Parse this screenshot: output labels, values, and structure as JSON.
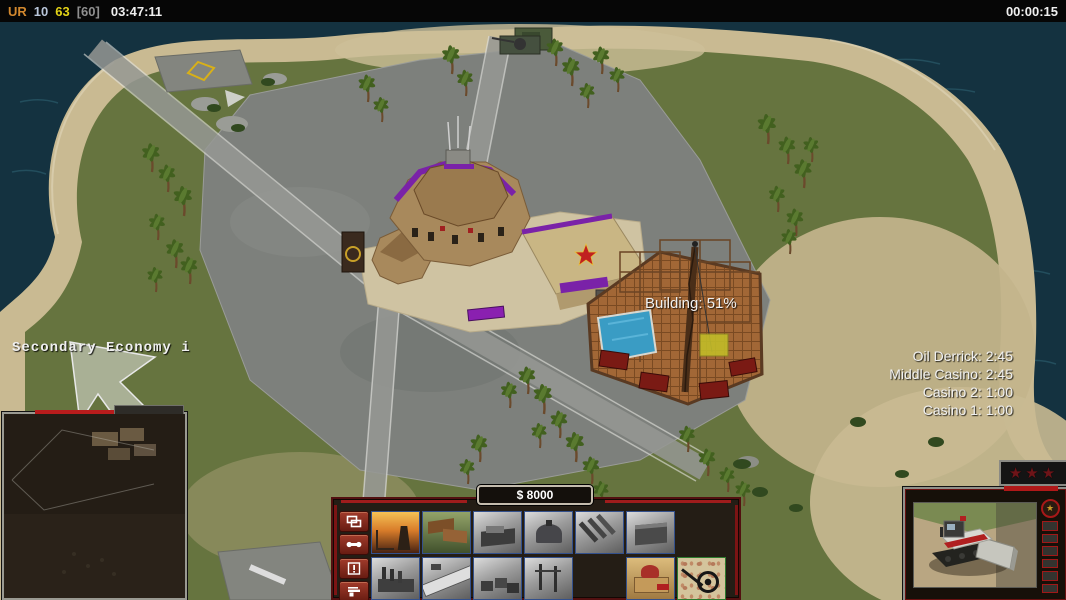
{
  "top_bar": {
    "faction": "UR",
    "stat1": "10",
    "stat2": "63",
    "stat3": "[60]",
    "clock": "03:47:11",
    "match_timer": "00:00:15"
  },
  "hud": {
    "console_message": "Secondary Economy i",
    "building_progress": "Building: 51%",
    "production_queue": [
      "Oil Derrick: 2:45",
      "Middle Casino: 2:45",
      "Casino 2: 1:00",
      "Casino 1: 1:00"
    ],
    "money": "$ 8000",
    "resolution_overlay": "1920 x 1080",
    "rank_stars": "★★★"
  },
  "command_bar": {
    "side_buttons": [
      {
        "name": "stacked-windows-icon"
      },
      {
        "name": "wrench-icon"
      },
      {
        "name": "alert-icon"
      },
      {
        "name": "beacon-gun-icon"
      }
    ],
    "build_buttons": [
      {
        "name": "power-plant-icon",
        "state": "available"
      },
      {
        "name": "barracks-icon",
        "state": "available"
      },
      {
        "name": "war-factory-icon",
        "state": "locked"
      },
      {
        "name": "propaganda-dome-icon",
        "state": "locked"
      },
      {
        "name": "artillery-site-icon",
        "state": "locked"
      },
      {
        "name": "supply-center-icon",
        "state": "locked"
      },
      {
        "name": "factory-icon",
        "state": "locked"
      },
      {
        "name": "airfield-icon",
        "state": "locked"
      },
      {
        "name": "depot-icon",
        "state": "locked"
      },
      {
        "name": "watchtower-icon",
        "state": "locked"
      },
      {
        "name": "casino-icon",
        "state": "available"
      },
      {
        "name": "mine-detector-icon",
        "state": "highlighted"
      }
    ]
  },
  "unit_panel": {
    "portrait": "construction-dozer-icon",
    "rank_cells": 6
  },
  "colors": {
    "ui_red": "#a01c1c",
    "locked_border": "#33508c",
    "highlight_border": "#2e7c2e",
    "top_faction": "#d2882e",
    "top_yellow": "#e3d317",
    "ocean": "#143240",
    "sand": "#c9ba92",
    "grass": "#66743f",
    "concrete": "#7d807c"
  }
}
